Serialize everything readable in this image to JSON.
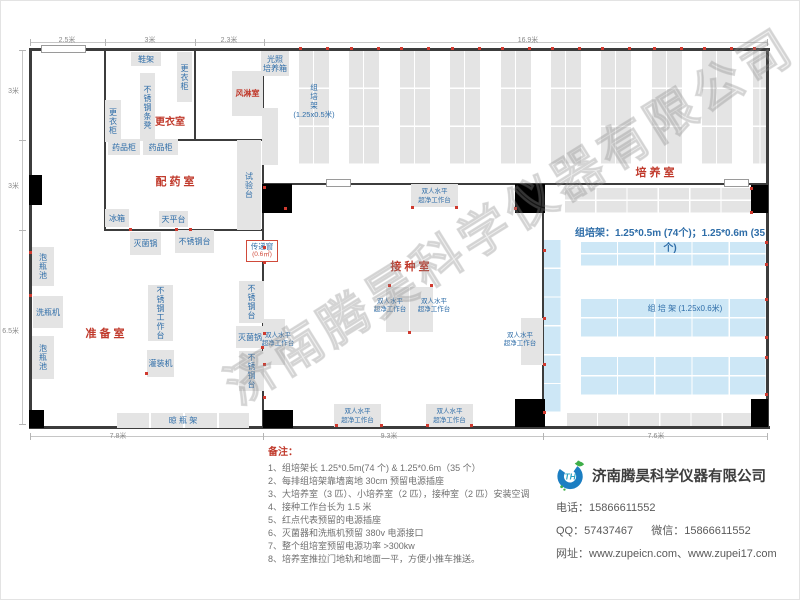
{
  "watermark": "济南腾昊科学仪器有限公司",
  "notes": {
    "title": "备注：",
    "items": [
      "1、组培架长 1.25*0.5m(74 个) & 1.25*0.6m（35 个）",
      "2、每排组培架靠墙离地 30cm 预留电源插座",
      "3、大培养室（3 匹）、小培养室（2 匹），接种室（2 匹）安装空调",
      "4、接种工作台长为 1.5 米",
      "5、红点代表预留的电源插座",
      "6、灭菌器和洗瓶机预留 380v 电源接口",
      "7、整个组培室预留电源功率 >300kw",
      "8、培养室推拉门地轨和地面一平，方便小推车推送。"
    ]
  },
  "company": {
    "name": "济南腾昊科学仪器有限公司",
    "phone_label": "电话：",
    "phone": "15866611552",
    "qq_label": "QQ：",
    "qq": "57437467",
    "wechat_label": "微信：",
    "wechat": "15866611552",
    "web_label": "网址：",
    "websites": "www.zupeicn.com、www.zupei17.com",
    "logo_text": "TH"
  },
  "dims": {
    "top": [
      {
        "label": "2.5米",
        "cx": 67
      },
      {
        "label": "3米",
        "cx": 150
      },
      {
        "label": "2.3米",
        "cx": 229
      },
      {
        "label": "16.9米",
        "cx": 528
      }
    ],
    "left": [
      {
        "label": "3米",
        "cy": 90
      },
      {
        "label": "3米",
        "cy": 185
      },
      {
        "label": "6.5米",
        "cy": 330
      }
    ],
    "bottom": [
      {
        "label": "7.8米",
        "cx": 118
      },
      {
        "label": "9.3米",
        "cx": 389
      },
      {
        "label": "7.6米",
        "cx": 656
      }
    ]
  },
  "floorplan": {
    "walls": [
      [
        29,
        48,
        741,
        3
      ],
      [
        29,
        426,
        741,
        3
      ],
      [
        29,
        48,
        3,
        381
      ],
      [
        766,
        48,
        3,
        381
      ],
      [
        104,
        50,
        2,
        181
      ],
      [
        194,
        50,
        2,
        91
      ],
      [
        262,
        50,
        2,
        377
      ],
      [
        542,
        184,
        2,
        243
      ],
      [
        104,
        139,
        160,
        2
      ],
      [
        104,
        229,
        160,
        2
      ],
      [
        262,
        183,
        282,
        2
      ],
      [
        542,
        183,
        226,
        2
      ]
    ],
    "doors": [
      [
        41,
        45,
        45,
        8
      ],
      [
        326,
        179,
        25,
        8
      ],
      [
        724,
        179,
        25,
        8
      ]
    ],
    "columns": [
      [
        29,
        175,
        13,
        30
      ],
      [
        262,
        184,
        30,
        29
      ],
      [
        515,
        184,
        30,
        29
      ],
      [
        751,
        185,
        17,
        28
      ],
      [
        29,
        410,
        15,
        18
      ],
      [
        263,
        410,
        30,
        18
      ],
      [
        515,
        399,
        30,
        28
      ],
      [
        751,
        399,
        17,
        28
      ]
    ],
    "racks_top": {
      "count": 10,
      "x0": 299,
      "pitch": 50.4,
      "y": 51,
      "w": 30,
      "h": 114,
      "last_w": 15
    },
    "gray_racks": [
      {
        "x": 565,
        "y": 188,
        "w": 188,
        "h": 26,
        "cols": 6,
        "rows": 2
      },
      {
        "x": 567,
        "y": 413,
        "w": 187,
        "h": 15,
        "cols": 6,
        "rows": 1
      }
    ],
    "blue_racks": [
      {
        "x": 543,
        "y": 240,
        "w": 19,
        "h": 173,
        "cols": 1,
        "rows": 6
      },
      {
        "x": 581,
        "y": 242,
        "w": 186,
        "h": 25,
        "cols": 5,
        "rows": 2
      },
      {
        "x": 581,
        "y": 299,
        "w": 186,
        "h": 39,
        "cols": 5,
        "rows": 2
      },
      {
        "x": 581,
        "y": 357,
        "w": 186,
        "h": 39,
        "cols": 5,
        "rows": 2
      }
    ],
    "equipment": [
      {
        "l": "鞋架",
        "x": 131,
        "y": 52,
        "w": 30,
        "h": 14
      },
      {
        "l": "更衣柜",
        "x": 177,
        "y": 52,
        "w": 15,
        "h": 50,
        "v": 1
      },
      {
        "l": "不锈钢条凳",
        "x": 140,
        "y": 73,
        "w": 15,
        "h": 68,
        "v": 1
      },
      {
        "l": "更衣柜",
        "x": 105,
        "y": 100,
        "w": 16,
        "h": 42,
        "v": 1
      },
      {
        "l": "风淋室",
        "x": 232,
        "y": 71,
        "w": 31,
        "h": 45,
        "red": 1
      },
      {
        "l": "光照\n培养箱",
        "x": 261,
        "y": 51,
        "w": 28,
        "h": 25
      },
      {
        "l": "",
        "x": 262,
        "y": 108,
        "w": 16,
        "h": 57
      },
      {
        "l": "药品柜",
        "x": 108,
        "y": 139,
        "w": 32,
        "h": 16
      },
      {
        "l": "药品柜",
        "x": 143,
        "y": 139,
        "w": 35,
        "h": 16
      },
      {
        "l": "试验台",
        "x": 237,
        "y": 140,
        "w": 24,
        "h": 90,
        "v": 1
      },
      {
        "l": "冰箱",
        "x": 105,
        "y": 209,
        "w": 24,
        "h": 18
      },
      {
        "l": "天平台",
        "x": 159,
        "y": 211,
        "w": 29,
        "h": 16
      },
      {
        "l": "灭菌锅",
        "x": 130,
        "y": 232,
        "w": 31,
        "h": 23
      },
      {
        "l": "不锈钢台",
        "x": 175,
        "y": 230,
        "w": 39,
        "h": 23
      },
      {
        "l": "泡瓶池",
        "x": 32,
        "y": 247,
        "w": 22,
        "h": 39,
        "v": 1
      },
      {
        "l": "洗瓶机",
        "x": 33,
        "y": 296,
        "w": 30,
        "h": 32
      },
      {
        "l": "泡瓶池",
        "x": 32,
        "y": 336,
        "w": 22,
        "h": 43,
        "v": 1
      },
      {
        "l": "不锈钢工作台",
        "x": 148,
        "y": 285,
        "w": 25,
        "h": 56,
        "v": 1
      },
      {
        "l": "灌装机",
        "x": 147,
        "y": 350,
        "w": 27,
        "h": 27
      },
      {
        "l": "不锈钢台",
        "x": 239,
        "y": 281,
        "w": 25,
        "h": 42,
        "v": 1
      },
      {
        "l": "灭菌锅",
        "x": 236,
        "y": 326,
        "w": 28,
        "h": 22
      },
      {
        "l": "不锈钢台",
        "x": 239,
        "y": 351,
        "w": 25,
        "h": 40,
        "v": 1
      },
      {
        "l": "晾  瓶  架",
        "x": 117,
        "y": 413,
        "w": 132,
        "h": 15,
        "seg": 1
      },
      {
        "l": "双人水平\n超净工作台",
        "x": 411,
        "y": 184,
        "w": 47,
        "h": 23,
        "small": 1
      },
      {
        "l": "双人水平\n超净工作台",
        "x": 334,
        "y": 404,
        "w": 47,
        "h": 23,
        "small": 1
      },
      {
        "l": "双人水平\n超净工作台",
        "x": 426,
        "y": 404,
        "w": 47,
        "h": 23,
        "small": 1
      },
      {
        "l": "",
        "x": 386,
        "y": 287,
        "w": 23,
        "h": 45
      },
      {
        "l": "",
        "x": 410,
        "y": 287,
        "w": 23,
        "h": 45
      },
      {
        "l": "",
        "x": 263,
        "y": 319,
        "w": 22,
        "h": 46
      },
      {
        "l": "",
        "x": 521,
        "y": 318,
        "w": 22,
        "h": 47
      }
    ],
    "floating_labels": [
      {
        "l": "双人水平\n超净工作台",
        "x": 368,
        "y": 298,
        "w": 44
      },
      {
        "l": "双人水平\n超净工作台",
        "x": 412,
        "y": 298,
        "w": 44
      },
      {
        "l": "双人水平\n超净工作台",
        "x": 256,
        "y": 332,
        "w": 44
      },
      {
        "l": "双人水平\n超净工作台",
        "x": 498,
        "y": 332,
        "w": 44
      }
    ],
    "room_labels": [
      {
        "l": "更衣室",
        "x": 140,
        "y": 113,
        "w": 60,
        "fs": 10
      },
      {
        "l": "配 药 室",
        "x": 130,
        "y": 173,
        "w": 90,
        "fs": 11
      },
      {
        "l": "准 备 室",
        "x": 60,
        "y": 325,
        "w": 90,
        "fs": 11
      },
      {
        "l": "接 种 室",
        "x": 365,
        "y": 258,
        "w": 90,
        "fs": 11
      },
      {
        "l": "培 养 室",
        "x": 610,
        "y": 164,
        "w": 90,
        "fs": 11
      }
    ],
    "pass_window": {
      "line1": "传递窗",
      "line2": "(0.6㎡)",
      "x": 246,
      "y": 240,
      "w": 32,
      "h": 22
    },
    "rack_top_label": {
      "text": "组\n培\n架\n(1.25x0.5米)",
      "x": 289,
      "y": 83,
      "w": 50
    },
    "rack_blue_label": {
      "text": "组  培  架 (1.25x0.6米)",
      "x": 615,
      "y": 303,
      "w": 140
    },
    "annotation": {
      "text": "组培架：1.25*0.5m (74个)；1.25*0.6m (35个)",
      "x": 570,
      "y": 224,
      "w": 200
    },
    "outlet_dots": [
      [
        299,
        47
      ],
      [
        326,
        47
      ],
      [
        350,
        47
      ],
      [
        377,
        47
      ],
      [
        400,
        47
      ],
      [
        427,
        47
      ],
      [
        451,
        47
      ],
      [
        478,
        47
      ],
      [
        501,
        47
      ],
      [
        528,
        47
      ],
      [
        551,
        47
      ],
      [
        578,
        47
      ],
      [
        601,
        47
      ],
      [
        628,
        47
      ],
      [
        653,
        47
      ],
      [
        680,
        47
      ],
      [
        703,
        47
      ],
      [
        730,
        47
      ],
      [
        753,
        47
      ],
      [
        263,
        186
      ],
      [
        263,
        246
      ],
      [
        263,
        261
      ],
      [
        263,
        332
      ],
      [
        263,
        363
      ],
      [
        263,
        396
      ],
      [
        129,
        228
      ],
      [
        175,
        228
      ],
      [
        189,
        228
      ],
      [
        145,
        372
      ],
      [
        261,
        346
      ],
      [
        388,
        284
      ],
      [
        430,
        284
      ],
      [
        408,
        331
      ],
      [
        335,
        424
      ],
      [
        380,
        424
      ],
      [
        426,
        424
      ],
      [
        470,
        424
      ],
      [
        411,
        206
      ],
      [
        455,
        206
      ],
      [
        284,
        207
      ],
      [
        514,
        207
      ],
      [
        543,
        249
      ],
      [
        543,
        317
      ],
      [
        543,
        363
      ],
      [
        543,
        411
      ],
      [
        765,
        241
      ],
      [
        765,
        263
      ],
      [
        765,
        298
      ],
      [
        765,
        336
      ],
      [
        765,
        356
      ],
      [
        765,
        393
      ],
      [
        750,
        187
      ],
      [
        750,
        211
      ],
      [
        29,
        251
      ],
      [
        29,
        294
      ]
    ]
  }
}
